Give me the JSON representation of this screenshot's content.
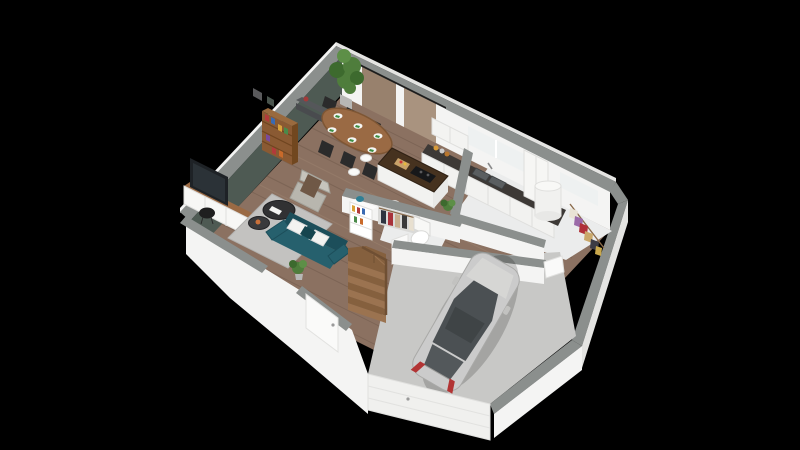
{
  "scene": {
    "kind": "isometric-3d-floor-plan-render",
    "floor": "ground-floor",
    "background_color": "#000000",
    "rooms": [
      {
        "name": "living-room",
        "furniture": [
          "teal-sofa",
          "white-pillows",
          "round-coffee-tables",
          "gray-armchair",
          "throw-blanket",
          "area-rug",
          "tv",
          "tv-console",
          "black-side-chair",
          "tall-bookshelf",
          "wall-console",
          "floor-plant"
        ]
      },
      {
        "name": "dining-area",
        "furniture": [
          "oval-wood-table",
          "black-chairs",
          "place-settings-with-green-napkins",
          "tall-potted-plant",
          "floor-to-ceiling-glazing"
        ]
      },
      {
        "name": "kitchen",
        "furniture": [
          "wall-cabinets",
          "dark-countertop",
          "double-sink",
          "window-over-sink",
          "tall-cabinet",
          "corner-counter",
          "coffee-machine",
          "spice-jars",
          "island-with-induction-hob",
          "cutting-board",
          "white-bar-stools"
        ]
      },
      {
        "name": "entry-hall",
        "furniture": [
          "front-door",
          "winder-staircase",
          "white-bookcase",
          "blue-vase",
          "coat-niche-with-clothes",
          "floor-plant"
        ]
      },
      {
        "name": "wc",
        "furniture": [
          "toilet",
          "door",
          "half-wall-plant"
        ]
      },
      {
        "name": "utility-room",
        "furniture": [
          "water-heater",
          "window"
        ]
      },
      {
        "name": "dressing-area",
        "furniture": [
          "clothes-rail",
          "hanging-clothes",
          "door-to-garage"
        ]
      },
      {
        "name": "garage",
        "furniture": [
          "silver-hatchback-car",
          "sectional-garage-door"
        ]
      }
    ],
    "counts": {
      "dining_chairs": 6,
      "place_settings": 6,
      "bar_stools": 4,
      "stair_steps": 8
    }
  },
  "palette": {
    "bg": "#000000",
    "cap": "#8b8f8d",
    "wall": "#f4f4f3",
    "wallShade": "#e4e4e2",
    "green": "#4e5a53",
    "wood": "#8b7161",
    "woodLine": "#6b5547",
    "woodLight": "#a78d78",
    "tile": "#ebecec",
    "concrete": "#c8c8c6",
    "rug": "#c3c2c0",
    "rugEdge": "#b2b1af",
    "sofa": "#26606d",
    "sofaDark": "#1c4e5a",
    "pillow": "#f3f3f1",
    "pillowTeal": "#16454f",
    "armchair": "#b8b6ae",
    "armchairLight": "#c6c4bc",
    "blanket": "#6f5846",
    "coffeeTable": "#313133",
    "coffeeTableDark": "#1e1e20",
    "tableWood": "#9a6a44",
    "tableWoodDark": "#7e5634",
    "chair": "#2b2b2b",
    "counterTop": "#3d3936",
    "islandTop": "#46321f",
    "islandTopDark": "#2f2114",
    "cabinet": "#f2f2f0",
    "cabinetLine": "#dfdfdd",
    "bookshelf": "#8a5a33",
    "bookshelfDark": "#71471f",
    "plant": "#4f7d3c",
    "plantDark": "#3d6a2e",
    "plantLight": "#5d8f47",
    "car": "#cbcbcb",
    "carShade": "#d6d6d4",
    "carEdge": "#a9a9a7",
    "carGlass": "#4b5053",
    "carGlassDark": "#3f4446",
    "carGlassLight": "#53585b",
    "taillight": "#b23434",
    "glassReflect": "#98816d",
    "glassLight": "#a9937f",
    "railDark": "#1d1d1d",
    "windowBright": "#eef1f1",
    "heater": "#f1f1ef",
    "stair": "#9b7350",
    "stairDark": "#85603e",
    "stairRail": "#6f4f33",
    "tv": "#1e2226",
    "tvScreen": "#2b3237",
    "vaseBlue": "#2e7f95",
    "doorWhite": "#fafaf9",
    "handle": "#9a9a9a",
    "napkin": "#3e8e41",
    "plate": "#f6f6f4",
    "board": "#c9a269",
    "jarOrange": "#d79a3a",
    "jarBrown": "#b8762e",
    "sink": "#5a5e60",
    "sinkDark": "#3c4042",
    "white": "#ffffff",
    "potGray": "#b7b7b5",
    "consoleDark": "#55575a",
    "frameGray": "#5a5a5c",
    "redDecor": "#a33a3a",
    "orangeDecor": "#c9703a"
  },
  "clothes_colors": [
    "#e9e3d5",
    "#9a6aa8",
    "#b03038",
    "#caa86a",
    "#3c3c44",
    "#c9a84c"
  ],
  "hall_clothes_colors": [
    "#2e3440",
    "#a8323a",
    "#c8b090",
    "#3a3a3a",
    "#e8e0d0"
  ],
  "book_colors": [
    "#b23a3a",
    "#3a6ab2",
    "#d9a23a",
    "#4a8a4a",
    "#7a4a9a",
    "#c96a2a"
  ]
}
